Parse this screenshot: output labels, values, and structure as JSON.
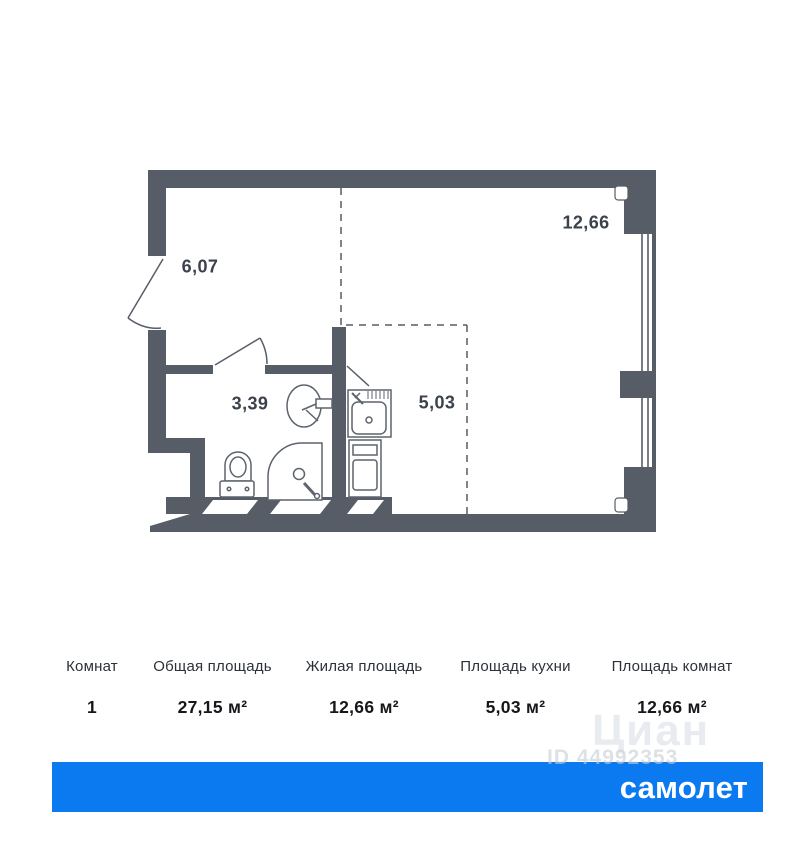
{
  "floor_plan": {
    "rooms": [
      {
        "name": "hallway",
        "area_label": "6,07"
      },
      {
        "name": "living-room",
        "area_label": "12,66"
      },
      {
        "name": "bathroom",
        "area_label": "3,39"
      },
      {
        "name": "kitchen",
        "area_label": "5,03"
      }
    ]
  },
  "summary_table": {
    "columns": [
      {
        "header": "Комнат",
        "value": "1"
      },
      {
        "header": "Общая площадь",
        "value": "27,15 м²"
      },
      {
        "header": "Жилая площадь",
        "value": "12,66 м²"
      },
      {
        "header": "Площадь кухни",
        "value": "5,03 м²"
      },
      {
        "header": "Площадь комнат",
        "value": "12,66 м²"
      }
    ]
  },
  "watermark": {
    "site_name": "Циан",
    "listing_id": "ID 44992353"
  },
  "brand_bar": {
    "logo_text": "самолет",
    "background_color": "#0b7af0"
  },
  "colors": {
    "wall": "#575d66",
    "fixture_line": "#5d646d",
    "plan_label": "#3c424b",
    "table_value": "#15171a",
    "brand_blue": "#0b7af0"
  }
}
